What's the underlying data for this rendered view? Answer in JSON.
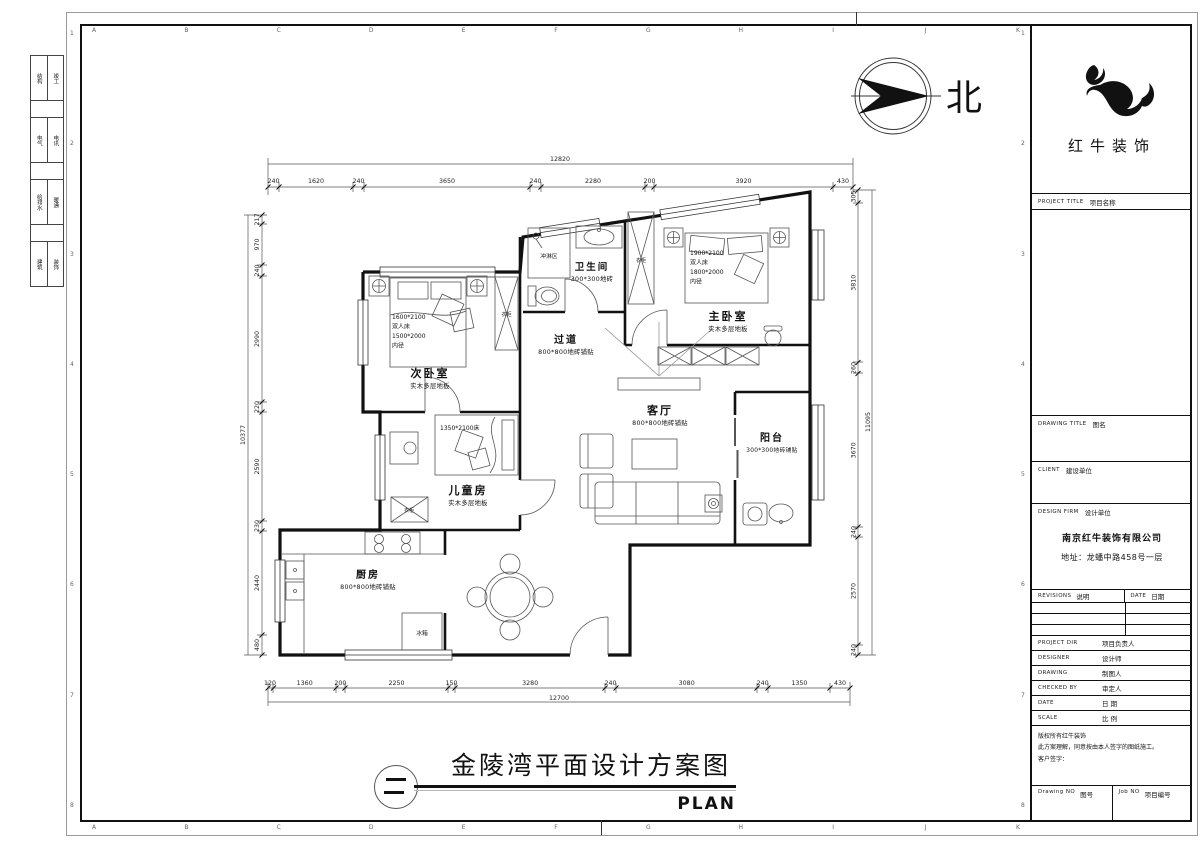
{
  "sheet": {
    "grid_letters": [
      "A",
      "B",
      "C",
      "D",
      "E",
      "F",
      "G",
      "H",
      "I",
      "J",
      "K"
    ],
    "grid_numbers": [
      "1",
      "2",
      "3",
      "4",
      "5",
      "6",
      "7",
      "8"
    ],
    "edge_strip": [
      {
        "left": "结构",
        "right": "竣工"
      },
      {
        "left": "电气",
        "right": "电讯"
      },
      {
        "left": "给排水",
        "right": "暖通"
      },
      {
        "left": "建筑",
        "right": "装饰"
      }
    ]
  },
  "north": {
    "label": "北"
  },
  "logo": {
    "name": "红牛装饰"
  },
  "title_block": {
    "project_title_en": "PROJECT TITLE",
    "project_title_zh": "项目名称",
    "drawing_title_en": "DRAWING TITLE",
    "drawing_title_zh": "图名",
    "client_en": "CLIENT",
    "client_zh": "建设单位",
    "design_firm_en": "DESIGN FIRM",
    "design_firm_zh": "设计单位",
    "firm_name": "南京红牛装饰有限公司",
    "firm_address": "地址：龙蟠中路458号一层",
    "revisions_en": "REVISIONS",
    "revisions_zh": "说明",
    "date_en": "DATE",
    "date_zh": "日期",
    "project_dir_en": "PROJECT DIR",
    "project_dir_zh": "项目负责人",
    "designer_en": "DESIGNER",
    "designer_zh": "设计师",
    "drawing_en": "DRAWING",
    "drawing_zh": "制图人",
    "checked_en": "CHECKED BY",
    "checked_zh": "审定人",
    "date2_en": "DATE",
    "date2_zh": "日 期",
    "scale_en": "SCALE",
    "scale_zh": "比 例",
    "disclaimer_1": "版权所有红牛装饰",
    "disclaimer_2": "此方案理解，同意按由本人签字的图纸施工。",
    "disclaimer_3": "客户签字：",
    "drawing_no_en": "Drawing NO",
    "drawing_no_zh": "图号",
    "job_no_en": "Job NO",
    "job_no_zh": "项目编号"
  },
  "plan": {
    "rooms": {
      "master_bedroom": {
        "name": "主卧室",
        "floor": "实木多层地板",
        "bed_note": [
          "1900*2100",
          "双人床",
          "1800*2000",
          "内径"
        ]
      },
      "second_bedroom": {
        "name": "次卧室",
        "floor": "实木多层地板",
        "bed_note": [
          "1600*2100",
          "双人床",
          "1500*2000",
          "内径"
        ]
      },
      "kids_room": {
        "name": "儿童房",
        "floor": "实木多层地板",
        "bed_note": "1350*2100床"
      },
      "living_room": {
        "name": "客厅",
        "floor": "800*800地砖铺贴"
      },
      "corridor": {
        "name": "过道",
        "floor": "800*800地砖铺贴"
      },
      "kitchen": {
        "name": "厨房",
        "floor": "800*800地砖铺贴"
      },
      "bathroom": {
        "name": "卫生间",
        "floor": "300*300地砖",
        "shower": "冲淋区"
      },
      "balcony": {
        "name": "阳台",
        "floor": "300*300地砖铺贴"
      }
    },
    "labels": {
      "wardrobe": "衣柜",
      "fridge": "冰箱"
    },
    "dims": {
      "top": {
        "total": "12820",
        "segments": [
          "240",
          "1620",
          "240",
          "3650",
          "240",
          "2280",
          "200",
          "3920",
          "430"
        ]
      },
      "bottom": {
        "total": "12700",
        "segments": [
          "120",
          "1360",
          "200",
          "2250",
          "150",
          "3280",
          "240",
          "3080",
          "240",
          "1350",
          "430"
        ]
      },
      "left": {
        "total": "10377",
        "segments": [
          "217",
          "970",
          "240",
          "2990",
          "220",
          "2590",
          "230",
          "2440",
          "480"
        ]
      },
      "right": {
        "total": "11095",
        "segments": [
          "305",
          "3810",
          "260",
          "3670",
          "240",
          "2570",
          "240"
        ]
      }
    }
  },
  "footer": {
    "title": "金陵湾平面设计方案图",
    "subtitle": "PLAN"
  }
}
